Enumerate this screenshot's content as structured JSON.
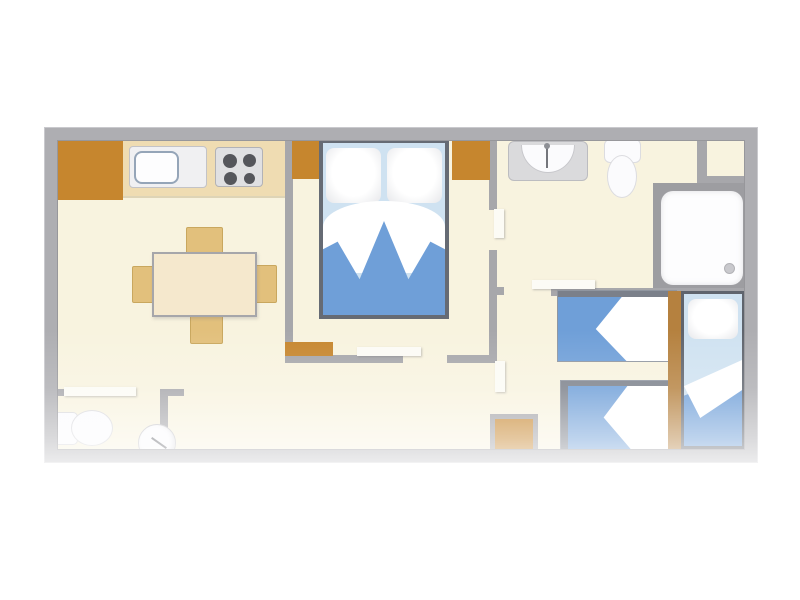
{
  "palette": {
    "wall": "#a7a7ab",
    "wall_light": "#c9c9cd",
    "floor": "#f8f3df",
    "counter": "#efdcb2",
    "wood": "#c6862e",
    "wood_strip": "#b5813f",
    "table": "#f5e8cd",
    "chair": "#e2c07c",
    "chair_border": "#c9a75e",
    "bed_frame": "#666b74",
    "blanket": "#6f9fd8",
    "sheet": "#cfe2f1",
    "linen": "#ffffff",
    "fixture": "#dadadc",
    "fixture_border": "#bcbcc0",
    "white_fixture": "#fbfbfd",
    "burner": "#55565b",
    "door_leaf": "#fcfbf5",
    "drain": "#c9c9cd"
  },
  "floorplan": {
    "type": "mobile-home top-down floor plan, no text labels",
    "rooms": [
      "kitchen-dining-living-area",
      "master-bedroom",
      "bathroom",
      "wc-room",
      "twin-bedroom",
      "hallway",
      "corner-storage-niche"
    ],
    "furniture": {
      "kitchen": [
        "corner-cabinet",
        "worktop-counter",
        "sink-unit",
        "stove-4-burners"
      ],
      "dining": [
        "table",
        "chair-top",
        "chair-bottom",
        "chair-left",
        "chair-right"
      ],
      "wc_room": [
        "toilet",
        "round-washbasin"
      ],
      "master_bedroom": [
        "double-bed-2-pillows",
        "wardrobe-top-left",
        "wardrobe-top-right",
        "low-cabinet",
        "sliding-door"
      ],
      "bathroom": [
        "vanity-washbasin-with-faucet",
        "toilet",
        "shower-cabin-with-drain"
      ],
      "twin_bedroom": [
        "single-bed-1",
        "single-bed-2",
        "side-bed-vertical",
        "wood-partition",
        "cabinet"
      ]
    }
  }
}
